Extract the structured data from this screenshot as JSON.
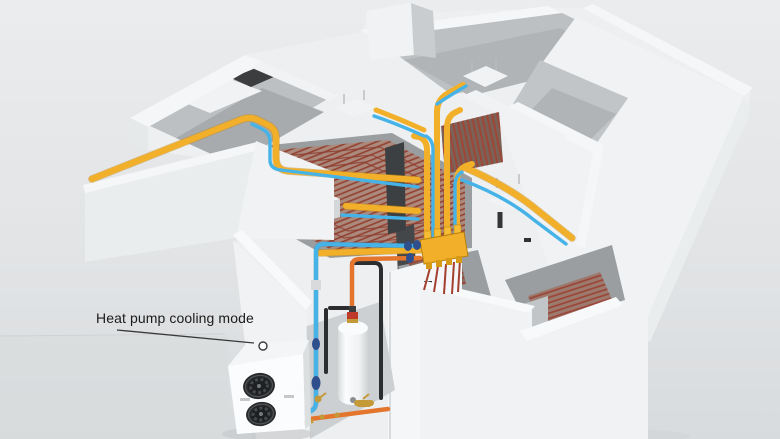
{
  "scene": {
    "annotation": {
      "label": "Heat pump cooling mode"
    },
    "components": {
      "heat_pump": "heat-pump-outdoor-unit",
      "water_tank": "buffer-water-tank",
      "manifold": "underfloor-distribution-manifold",
      "ducts": "air-supply-ducts",
      "underfloor_coils": "underfloor-pipe-coils",
      "ceiling_units": "ceiling-fan-coil-units"
    },
    "colors": {
      "background_top": "#e9ebec",
      "background_bottom": "#dcdfe1",
      "wall_white": "#f2f4f5",
      "interior_gray": "#b9bcbe",
      "floor_gray": "#a6a9ab",
      "duct_yellow": "#f2b02a",
      "duct_yellow_dark": "#c8860c",
      "pipe_blue": "#45b3e8",
      "pipe_blue_dark": "#2a84b8",
      "pipe_navy": "#2f4f8c",
      "pipe_orange": "#e4752c",
      "pipe_black": "#2b2d2f",
      "coil_red": "#92402f",
      "coil_base": "#ab8a7d",
      "brass": "#c49a38",
      "tank_white": "#fafbfc",
      "fan_dark": "#27292b",
      "label_text": "#1b1b1b",
      "leader_line": "#3a3a3a"
    }
  }
}
